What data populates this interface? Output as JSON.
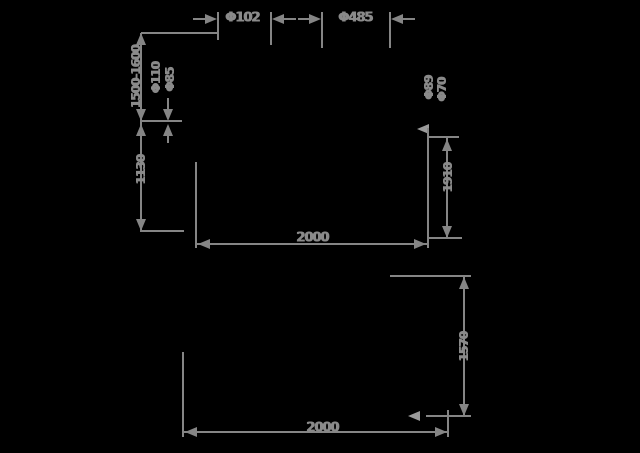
{
  "drawing": {
    "bg_color": "#000000",
    "line_color": "#858585",
    "top_view": {
      "pole_diameter": "Φ102",
      "ring_diameter": "Φ485",
      "height_range": "1500-1600",
      "mid_height": "1130",
      "left_tube_labels": [
        "Φ110",
        "Φ85"
      ],
      "right_tube_labels": [
        "Φ89",
        "Φ70"
      ],
      "right_height": "1910",
      "width": "2000"
    },
    "front_view": {
      "height": "1570",
      "width": "2000"
    }
  }
}
